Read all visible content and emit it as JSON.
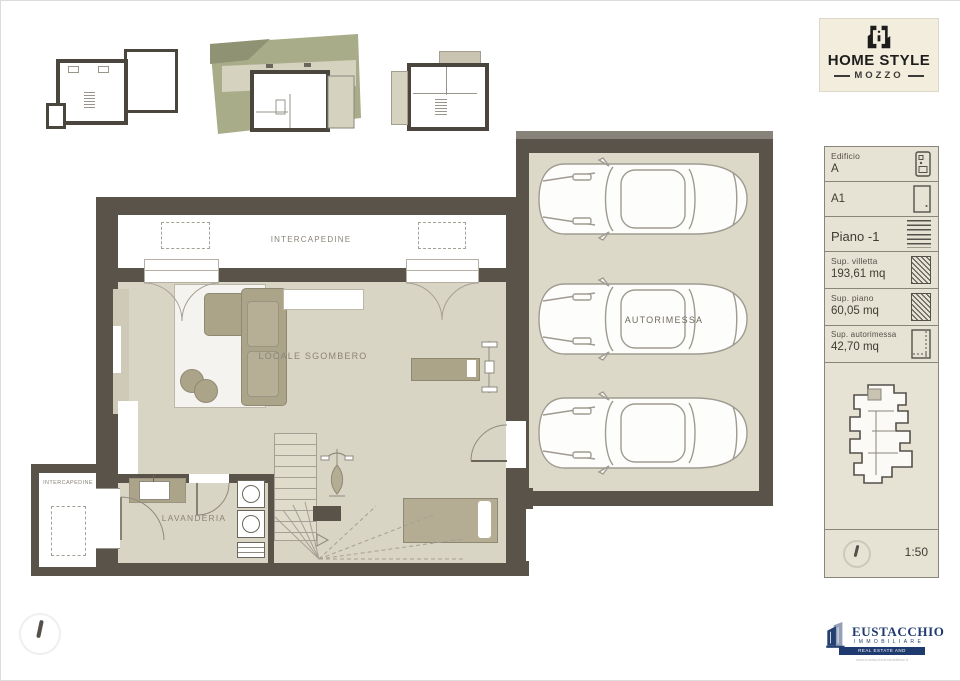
{
  "brand": {
    "name": "HOME STYLE",
    "city": "MOZZO"
  },
  "floor_plan": {
    "room_labels": {
      "intercapedine_top": "INTERCAPEDINE",
      "locale_sgombero": "LOCALE SGOMBERO",
      "lavanderia": "LAVANDERIA",
      "intercapedine_side": "INTERCAPEDINE",
      "autorimessa": "AUTORIMESSA"
    }
  },
  "info_panel": {
    "edificio_label": "Edificio",
    "edificio_value": "A",
    "unit_value": "A1",
    "floor_value": "Piano -1",
    "sup_villetta_label": "Sup. villetta",
    "sup_villetta_value": "193,61 mq",
    "sup_piano_label": "Sup. piano",
    "sup_piano_value": "60,05 mq",
    "sup_autorimessa_label": "Sup. autorimessa",
    "sup_autorimessa_value": "42,70 mq",
    "scale_value": "1:50"
  },
  "agency": {
    "name": "EUSTACCHIO",
    "subtitle": "IMMOBILIARE",
    "banner": "REAL ESTATE AND INVESTMENTS",
    "website": "www.eustacchioimmobiliare.it"
  },
  "colors": {
    "wall": "#59534a",
    "floor": "#d9d5c4",
    "garage_floor": "#ddd9c9",
    "furniture": "#aba489",
    "panel_bg": "#e7e3d4",
    "brand_bg": "#f2eddd",
    "site_green": "#a9ac88",
    "agency_navy": "#1e3a6e"
  }
}
